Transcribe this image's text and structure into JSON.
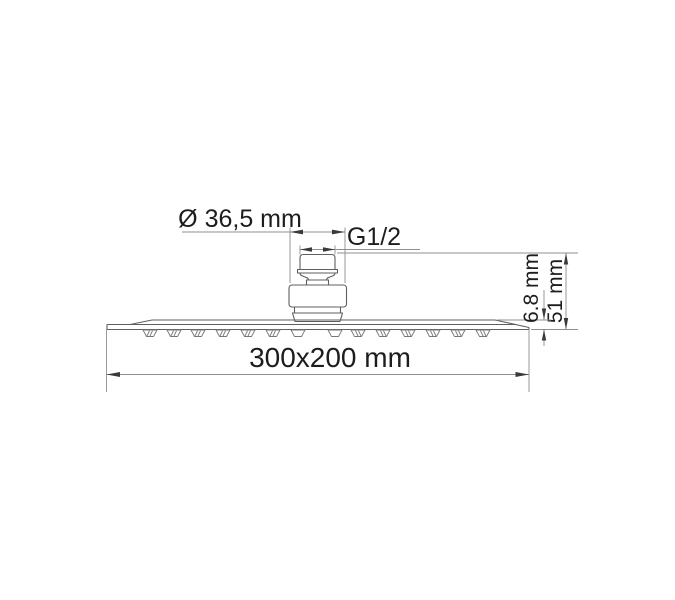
{
  "figure": {
    "description": "Technical dimension drawing of a rectangular overhead rain shower head, side elevation",
    "background_color": "#ffffff",
    "part_line_color": "#5f5f5f",
    "dimension_line_color": "#8f8f8f",
    "text_color": "#1d1d1d",
    "dimensions": {
      "connector_diameter": "Ø 36,5 mm",
      "thread": "G1/2",
      "plate_thickness": "6.8 mm",
      "total_height": "51 mm",
      "plate_size": "300x200 mm"
    }
  }
}
